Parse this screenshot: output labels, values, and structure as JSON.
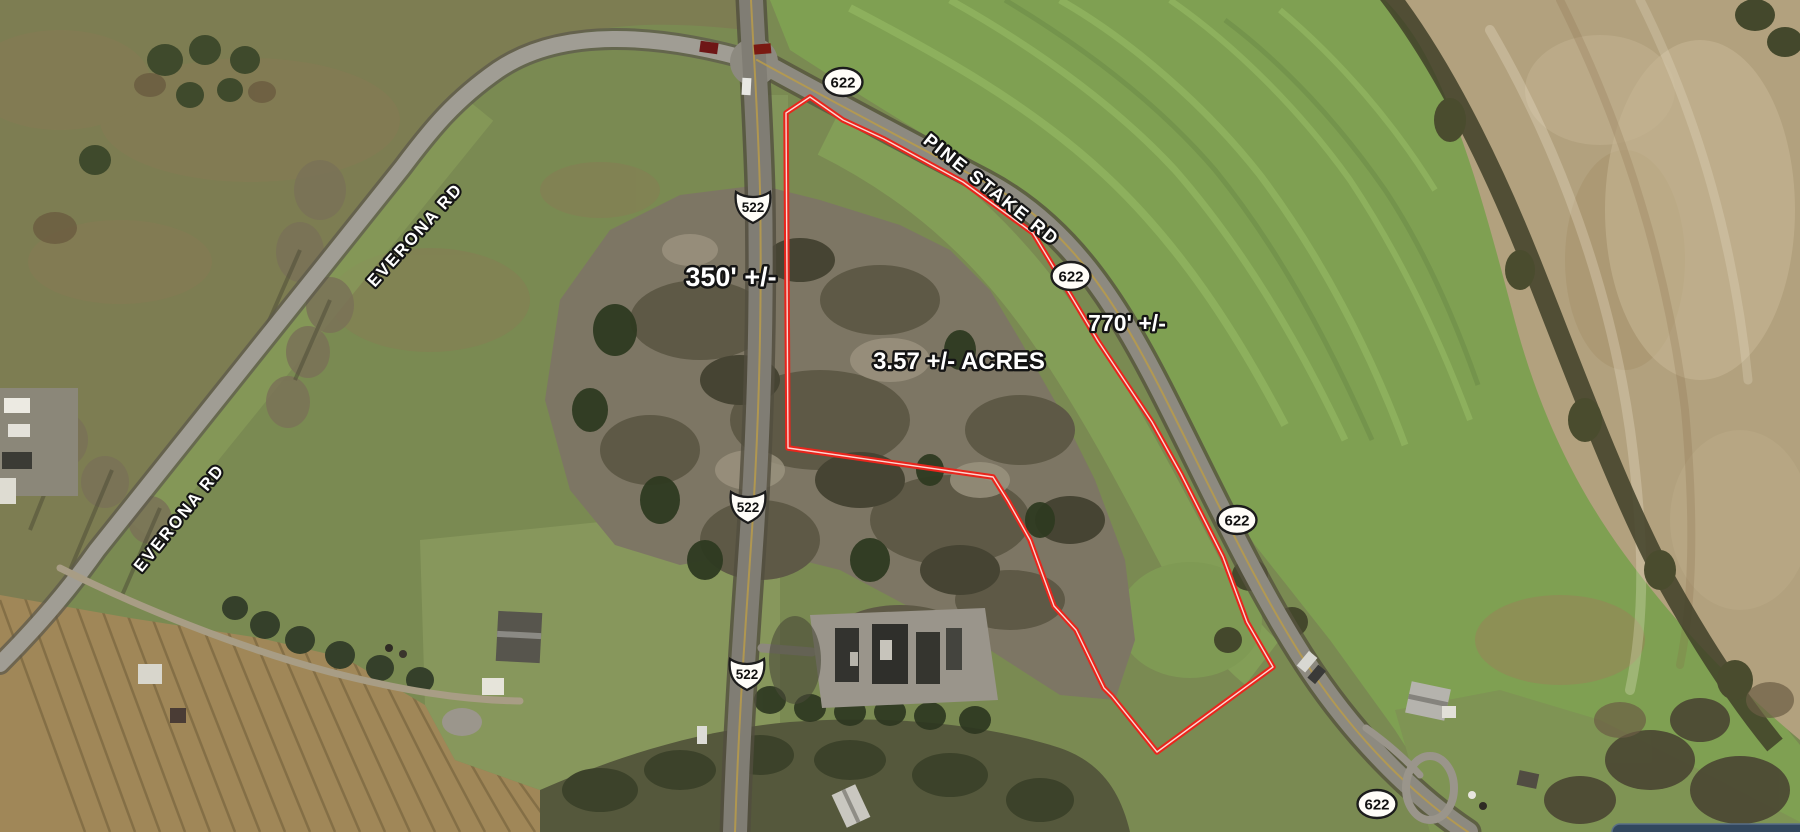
{
  "map": {
    "description": "Aerial property map with outlined parcel",
    "parcel": {
      "acreage_label": "3.57 +/- ACRES",
      "frontage_left": "350' +/-",
      "frontage_right": "770' +/-",
      "boundary_color": "#e8251c",
      "outline_points": "786,113 810,97 843,120 884,139 963,182 1033,233 1062,281 1098,341 1152,422 1181,474 1223,557 1247,622 1273,667 1157,752 1112,696 1104,688 1076,630 1054,606 1030,540 1008,501 993,477 788,448"
    },
    "road_labels": {
      "pine_stake": "PINE STAKE RD",
      "everona_upper": "EVERONA RD",
      "everona_lower": "EVERONA RD"
    },
    "route_shields": {
      "secondary_622": "622",
      "us_522": "522"
    },
    "palette": {
      "field_green": "#7a8a52",
      "bright_field_green": "#7fa052",
      "pasture_olive": "#7d7d52",
      "plowed_tan": "#b2a17e",
      "woods_gray": "#7d7664",
      "evergreen": "#2e3a21",
      "road_gray": "#8d8a80",
      "boundary_red": "#e8251c"
    }
  }
}
